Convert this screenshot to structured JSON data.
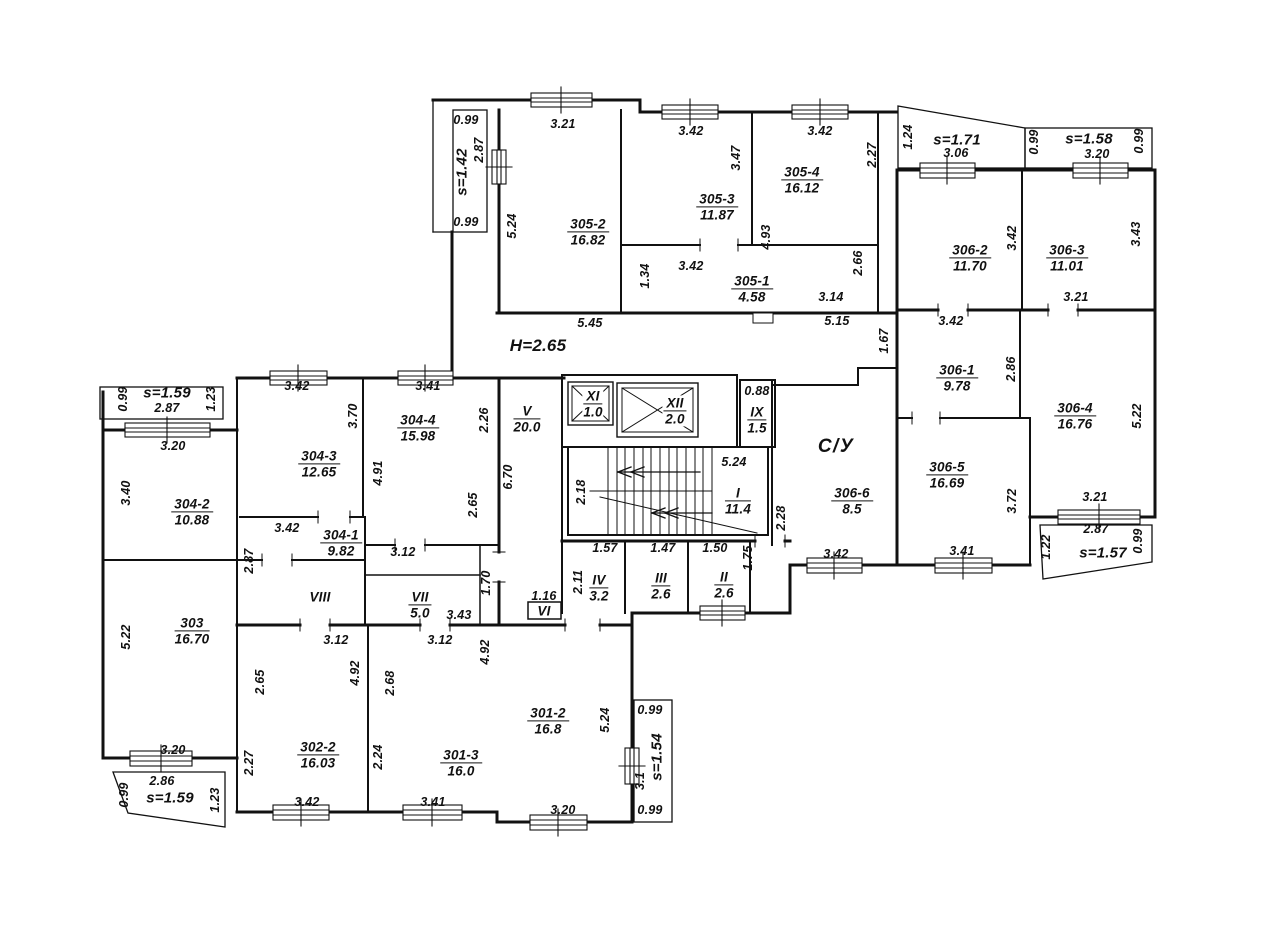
{
  "plan": {
    "height_note": "Н=2.65",
    "sanitary_label": "С/У",
    "rooms": [
      {
        "name": "305-2",
        "area": "16.82",
        "x": 588,
        "y": 232
      },
      {
        "name": "305-3",
        "area": "11.87",
        "x": 717,
        "y": 207
      },
      {
        "name": "305-4",
        "area": "16.12",
        "x": 802,
        "y": 180
      },
      {
        "name": "305-1",
        "area": "4.58",
        "x": 752,
        "y": 289
      },
      {
        "name": "306-2",
        "area": "11.70",
        "x": 970,
        "y": 258
      },
      {
        "name": "306-3",
        "area": "11.01",
        "x": 1067,
        "y": 258
      },
      {
        "name": "306-1",
        "area": "9.78",
        "x": 957,
        "y": 378
      },
      {
        "name": "306-4",
        "area": "16.76",
        "x": 1075,
        "y": 416
      },
      {
        "name": "306-5",
        "area": "16.69",
        "x": 947,
        "y": 475
      },
      {
        "name": "306-6",
        "area": "8.5",
        "x": 852,
        "y": 501
      },
      {
        "name": "304-2",
        "area": "10.88",
        "x": 192,
        "y": 512
      },
      {
        "name": "304-3",
        "area": "12.65",
        "x": 319,
        "y": 464
      },
      {
        "name": "304-4",
        "area": "15.98",
        "x": 418,
        "y": 428
      },
      {
        "name": "304-1",
        "area": "9.82",
        "x": 341,
        "y": 543
      },
      {
        "name": "303",
        "area": "16.70",
        "x": 192,
        "y": 631
      },
      {
        "name": "302-2",
        "area": "16.03",
        "x": 318,
        "y": 755
      },
      {
        "name": "301-3",
        "area": "16.0",
        "x": 461,
        "y": 763
      },
      {
        "name": "301-2",
        "area": "16.8",
        "x": 548,
        "y": 721
      },
      {
        "name": "V",
        "area": "20.0",
        "x": 527,
        "y": 419
      },
      {
        "name": "I",
        "area": "11.4",
        "x": 738,
        "y": 501
      },
      {
        "name": "XI",
        "area": "1.0",
        "x": 593,
        "y": 404,
        "bg": 1
      },
      {
        "name": "XII",
        "area": "2.0",
        "x": 675,
        "y": 411,
        "bg": 1
      },
      {
        "name": "IX",
        "area": "1.5",
        "x": 757,
        "y": 420
      },
      {
        "name": "IV",
        "area": "3.2",
        "x": 599,
        "y": 588
      },
      {
        "name": "III",
        "area": "2.6",
        "x": 661,
        "y": 586
      },
      {
        "name": "II",
        "area": "2.6",
        "x": 724,
        "y": 585
      },
      {
        "name": "VII",
        "area": "5.0",
        "x": 420,
        "y": 605
      }
    ],
    "halls": [
      {
        "name": "VIII",
        "x": 320,
        "y": 597
      },
      {
        "name": "VI",
        "x": 544,
        "y": 611
      }
    ],
    "balcony_labels": [
      {
        "label": "s=1.42",
        "x": 462,
        "y": 172,
        "r": 1
      },
      {
        "label": "s=1.59",
        "x": 167,
        "y": 393
      },
      {
        "label": "s=1.71",
        "x": 957,
        "y": 140
      },
      {
        "label": "s=1.58",
        "x": 1089,
        "y": 139
      },
      {
        "label": "s=1.57",
        "x": 1103,
        "y": 553
      },
      {
        "label": "s=1.54",
        "x": 657,
        "y": 757,
        "r": 1
      },
      {
        "label": "s=1.59",
        "x": 170,
        "y": 798
      }
    ],
    "dimensions": [
      {
        "v": "0.99",
        "x": 466,
        "y": 120
      },
      {
        "v": "2.87",
        "x": 479,
        "y": 150,
        "r": 1
      },
      {
        "v": "0.99",
        "x": 466,
        "y": 222
      },
      {
        "v": "3.21",
        "x": 563,
        "y": 124
      },
      {
        "v": "5.24",
        "x": 512,
        "y": 226,
        "r": 1
      },
      {
        "v": "3.42",
        "x": 691,
        "y": 131
      },
      {
        "v": "3.47",
        "x": 736,
        "y": 158,
        "r": 1
      },
      {
        "v": "3.42",
        "x": 820,
        "y": 131
      },
      {
        "v": "2.27",
        "x": 872,
        "y": 155,
        "r": 1
      },
      {
        "v": "1.24",
        "x": 908,
        "y": 137,
        "r": 1
      },
      {
        "v": "3.06",
        "x": 956,
        "y": 153
      },
      {
        "v": "0.99",
        "x": 1034,
        "y": 142,
        "r": 1
      },
      {
        "v": "3.20",
        "x": 1097,
        "y": 154
      },
      {
        "v": "0.99",
        "x": 1139,
        "y": 141,
        "r": 1
      },
      {
        "v": "1.34",
        "x": 645,
        "y": 276,
        "r": 1
      },
      {
        "v": "3.42",
        "x": 691,
        "y": 266
      },
      {
        "v": "4.93",
        "x": 766,
        "y": 237,
        "r": 1
      },
      {
        "v": "2.66",
        "x": 858,
        "y": 263,
        "r": 1
      },
      {
        "v": "3.14",
        "x": 831,
        "y": 297
      },
      {
        "v": "5.45",
        "x": 590,
        "y": 323
      },
      {
        "v": "5.15",
        "x": 837,
        "y": 321
      },
      {
        "v": "1.67",
        "x": 884,
        "y": 341,
        "r": 1
      },
      {
        "v": "3.42",
        "x": 1012,
        "y": 238,
        "r": 1
      },
      {
        "v": "3.43",
        "x": 1136,
        "y": 234,
        "r": 1
      },
      {
        "v": "3.21",
        "x": 1076,
        "y": 297
      },
      {
        "v": "3.42",
        "x": 951,
        "y": 321
      },
      {
        "v": "2.86",
        "x": 1011,
        "y": 369,
        "r": 1
      },
      {
        "v": "5.22",
        "x": 1137,
        "y": 416,
        "r": 1
      },
      {
        "v": "3.72",
        "x": 1012,
        "y": 501,
        "r": 1
      },
      {
        "v": "3.41",
        "x": 962,
        "y": 551
      },
      {
        "v": "3.42",
        "x": 836,
        "y": 554
      },
      {
        "v": "3.21",
        "x": 1095,
        "y": 497
      },
      {
        "v": "2.87",
        "x": 1096,
        "y": 529
      },
      {
        "v": "1.22",
        "x": 1046,
        "y": 547,
        "r": 1
      },
      {
        "v": "0.99",
        "x": 1138,
        "y": 541,
        "r": 1
      },
      {
        "v": "2.28",
        "x": 781,
        "y": 518,
        "r": 1
      },
      {
        "v": "0.88",
        "x": 757,
        "y": 391
      },
      {
        "v": "5.24",
        "x": 734,
        "y": 462
      },
      {
        "v": "2.18",
        "x": 581,
        "y": 492,
        "r": 1
      },
      {
        "v": "1.57",
        "x": 605,
        "y": 548
      },
      {
        "v": "1.47",
        "x": 663,
        "y": 548
      },
      {
        "v": "1.50",
        "x": 715,
        "y": 548
      },
      {
        "v": "1.75",
        "x": 748,
        "y": 558,
        "r": 1
      },
      {
        "v": "2.11",
        "x": 578,
        "y": 582,
        "r": 1
      },
      {
        "v": "6.70",
        "x": 508,
        "y": 477,
        "r": 1
      },
      {
        "v": "2.65",
        "x": 473,
        "y": 505,
        "r": 1
      },
      {
        "v": "1.70",
        "x": 486,
        "y": 583,
        "r": 1
      },
      {
        "v": "1.16",
        "x": 544,
        "y": 596
      },
      {
        "v": "3.43",
        "x": 459,
        "y": 615
      },
      {
        "v": "3.12",
        "x": 403,
        "y": 552
      },
      {
        "v": "3.42",
        "x": 297,
        "y": 386
      },
      {
        "v": "3.41",
        "x": 428,
        "y": 386
      },
      {
        "v": "3.70",
        "x": 353,
        "y": 416,
        "r": 1
      },
      {
        "v": "2.26",
        "x": 484,
        "y": 420,
        "r": 1
      },
      {
        "v": "4.91",
        "x": 378,
        "y": 473,
        "r": 1
      },
      {
        "v": "3.20",
        "x": 173,
        "y": 446
      },
      {
        "v": "3.40",
        "x": 126,
        "y": 493,
        "r": 1
      },
      {
        "v": "3.42",
        "x": 287,
        "y": 528
      },
      {
        "v": "2.87",
        "x": 249,
        "y": 561,
        "r": 1
      },
      {
        "v": "5.22",
        "x": 126,
        "y": 637,
        "r": 1
      },
      {
        "v": "2.65",
        "x": 260,
        "y": 682,
        "r": 1
      },
      {
        "v": "3.12",
        "x": 336,
        "y": 640
      },
      {
        "v": "3.12",
        "x": 440,
        "y": 640
      },
      {
        "v": "4.92",
        "x": 355,
        "y": 673,
        "r": 1
      },
      {
        "v": "2.68",
        "x": 390,
        "y": 683,
        "r": 1
      },
      {
        "v": "4.92",
        "x": 485,
        "y": 652,
        "r": 1
      },
      {
        "v": "2.27",
        "x": 249,
        "y": 763,
        "r": 1
      },
      {
        "v": "2.24",
        "x": 378,
        "y": 757,
        "r": 1
      },
      {
        "v": "3.20",
        "x": 173,
        "y": 750
      },
      {
        "v": "2.86",
        "x": 162,
        "y": 781
      },
      {
        "v": "0.99",
        "x": 124,
        "y": 795,
        "r": 1
      },
      {
        "v": "1.23",
        "x": 215,
        "y": 800,
        "r": 1
      },
      {
        "v": "3.42",
        "x": 307,
        "y": 802
      },
      {
        "v": "3.41",
        "x": 433,
        "y": 802
      },
      {
        "v": "5.24",
        "x": 605,
        "y": 720,
        "r": 1
      },
      {
        "v": "3.20",
        "x": 563,
        "y": 810
      },
      {
        "v": "0.99",
        "x": 650,
        "y": 710
      },
      {
        "v": "3.1",
        "x": 640,
        "y": 781,
        "r": 1
      },
      {
        "v": "0.99",
        "x": 650,
        "y": 810
      },
      {
        "v": "2.87",
        "x": 167,
        "y": 408
      },
      {
        "v": "0.99",
        "x": 123,
        "y": 399,
        "r": 1
      },
      {
        "v": "1.23",
        "x": 211,
        "y": 399,
        "r": 1
      }
    ]
  }
}
